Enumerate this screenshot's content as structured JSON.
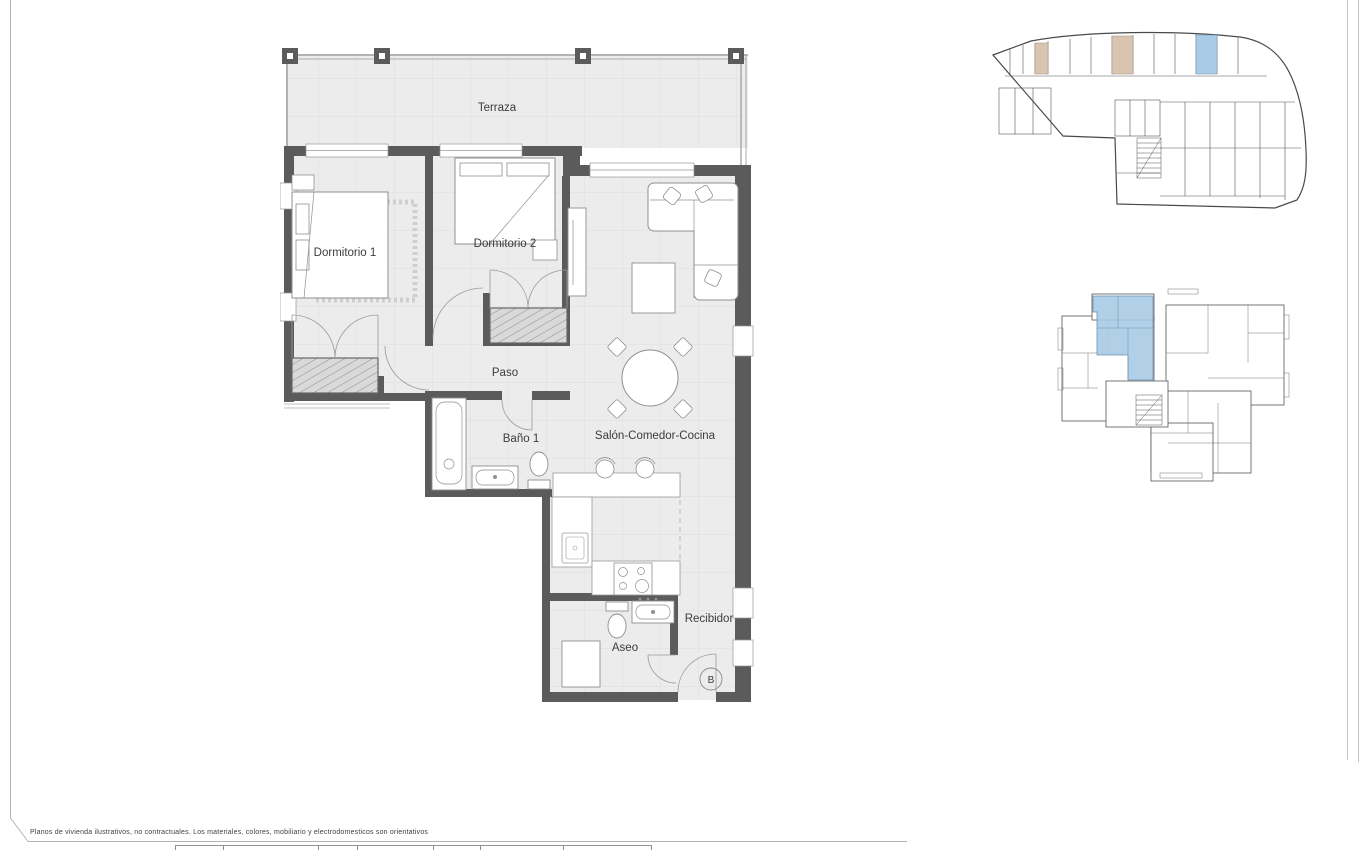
{
  "page": {
    "disclaimer": "Planos de vivienda ilustrativos, no contractuales. Los materiales, colores, mobiliario y electrodomesticos son orientativos"
  },
  "main_plan": {
    "rooms": {
      "terraza": "Terraza",
      "dormitorio1": "Dormitorio 1",
      "dormitorio2": "Dormitorio 2",
      "paso": "Paso",
      "bano1": "Baño 1",
      "salon": "Salón-Comedor-Cocina",
      "aseo": "Aseo",
      "recibidor": "Recibidor"
    },
    "unit_marker": "B"
  },
  "key_plans": {
    "garage_plan": {
      "description": "basement parking key plan",
      "highlighted_storage_color": "#d8c4b0",
      "highlighted_parking_color": "#a9cbe5"
    },
    "floor_key_plan": {
      "description": "floor key plan with unit highlighted",
      "highlighted_unit_color": "#a9cbe5"
    }
  },
  "colors": {
    "wall": "#5b5b5b",
    "floor": "#ececec",
    "grid_line": "#dedede",
    "furniture_line": "#8f8f8f",
    "highlight_blue": "#a9cbe5",
    "highlight_tan": "#d8c4b0",
    "frame_line": "#b4b4b4"
  }
}
